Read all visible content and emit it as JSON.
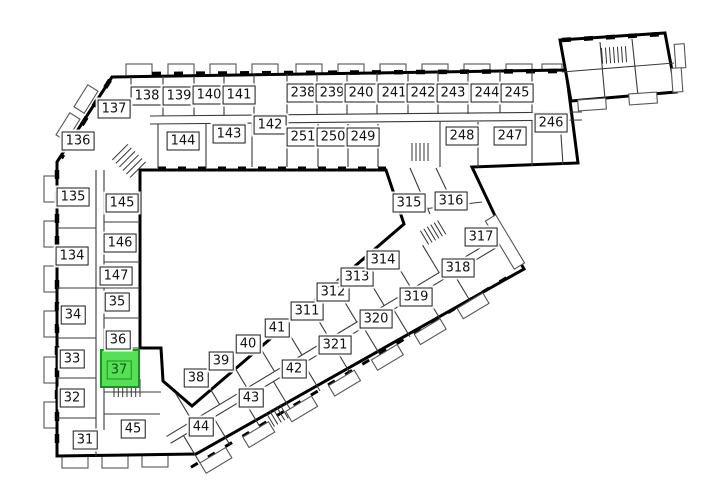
{
  "plan": {
    "name": "building-floor-plan",
    "highlighted_unit": "37",
    "colors": {
      "background": "#ffffff",
      "walls": "#000000",
      "label_bg": "#ffffff",
      "label_border": "#1a1a1a",
      "label_text": "#111111",
      "highlight_fill": "#57df57",
      "highlight_border": "#18931d",
      "highlight_text": "#0c5c10"
    },
    "units": [
      {
        "label": "138",
        "x": 147,
        "y": 96,
        "wing": "top-upper"
      },
      {
        "label": "139",
        "x": 179,
        "y": 96,
        "wing": "top-upper"
      },
      {
        "label": "140",
        "x": 209,
        "y": 95,
        "wing": "top-upper"
      },
      {
        "label": "141",
        "x": 239,
        "y": 95,
        "wing": "top-upper"
      },
      {
        "label": "238",
        "x": 303,
        "y": 93,
        "wing": "top-upper"
      },
      {
        "label": "239",
        "x": 332,
        "y": 93,
        "wing": "top-upper"
      },
      {
        "label": "240",
        "x": 361,
        "y": 93,
        "wing": "top-upper"
      },
      {
        "label": "241",
        "x": 394,
        "y": 93,
        "wing": "top-upper"
      },
      {
        "label": "242",
        "x": 423,
        "y": 93,
        "wing": "top-upper"
      },
      {
        "label": "243",
        "x": 453,
        "y": 93,
        "wing": "top-upper"
      },
      {
        "label": "244",
        "x": 487,
        "y": 93,
        "wing": "top-upper"
      },
      {
        "label": "245",
        "x": 517,
        "y": 93,
        "wing": "top-upper"
      },
      {
        "label": "137",
        "x": 114,
        "y": 109,
        "wing": "top-lower"
      },
      {
        "label": "136",
        "x": 78,
        "y": 141,
        "wing": "top-lower"
      },
      {
        "label": "144",
        "x": 183,
        "y": 141,
        "wing": "top-lower"
      },
      {
        "label": "143",
        "x": 229,
        "y": 134,
        "wing": "top-lower"
      },
      {
        "label": "142",
        "x": 270,
        "y": 125,
        "wing": "top-lower"
      },
      {
        "label": "251",
        "x": 303,
        "y": 137,
        "wing": "top-lower"
      },
      {
        "label": "250",
        "x": 333,
        "y": 137,
        "wing": "top-lower"
      },
      {
        "label": "249",
        "x": 363,
        "y": 137,
        "wing": "top-lower"
      },
      {
        "label": "248",
        "x": 462,
        "y": 136,
        "wing": "top-lower"
      },
      {
        "label": "247",
        "x": 510,
        "y": 136,
        "wing": "top-lower"
      },
      {
        "label": "246",
        "x": 551,
        "y": 123,
        "wing": "top-lower"
      },
      {
        "label": "135",
        "x": 73,
        "y": 197,
        "wing": "left"
      },
      {
        "label": "145",
        "x": 122,
        "y": 203,
        "wing": "left"
      },
      {
        "label": "146",
        "x": 120,
        "y": 243,
        "wing": "left"
      },
      {
        "label": "134",
        "x": 72,
        "y": 256,
        "wing": "left"
      },
      {
        "label": "147",
        "x": 116,
        "y": 276,
        "wing": "left"
      },
      {
        "label": "35",
        "x": 117,
        "y": 302,
        "wing": "left"
      },
      {
        "label": "34",
        "x": 73,
        "y": 315,
        "wing": "left"
      },
      {
        "label": "36",
        "x": 118,
        "y": 340,
        "wing": "left"
      },
      {
        "label": "33",
        "x": 72,
        "y": 359,
        "wing": "left"
      },
      {
        "label": "37",
        "x": 119,
        "y": 370,
        "wing": "left",
        "highlighted": true,
        "room": {
          "x": 100,
          "y": 349,
          "w": 40,
          "h": 39
        }
      },
      {
        "label": "32",
        "x": 72,
        "y": 398,
        "wing": "left"
      },
      {
        "label": "31",
        "x": 85,
        "y": 440,
        "wing": "left"
      },
      {
        "label": "45",
        "x": 133,
        "y": 429,
        "wing": "left"
      },
      {
        "label": "38",
        "x": 196,
        "y": 378,
        "wing": "diagonal-upper"
      },
      {
        "label": "39",
        "x": 221,
        "y": 361,
        "wing": "diagonal-upper"
      },
      {
        "label": "40",
        "x": 248,
        "y": 344,
        "wing": "diagonal-upper"
      },
      {
        "label": "41",
        "x": 277,
        "y": 328,
        "wing": "diagonal-upper"
      },
      {
        "label": "311",
        "x": 307,
        "y": 311,
        "wing": "diagonal-upper"
      },
      {
        "label": "312",
        "x": 333,
        "y": 292,
        "wing": "diagonal-upper"
      },
      {
        "label": "313",
        "x": 357,
        "y": 277,
        "wing": "diagonal-upper"
      },
      {
        "label": "314",
        "x": 383,
        "y": 260,
        "wing": "diagonal-upper"
      },
      {
        "label": "44",
        "x": 201,
        "y": 427,
        "wing": "diagonal-lower"
      },
      {
        "label": "43",
        "x": 251,
        "y": 398,
        "wing": "diagonal-lower"
      },
      {
        "label": "42",
        "x": 294,
        "y": 369,
        "wing": "diagonal-lower"
      },
      {
        "label": "321",
        "x": 335,
        "y": 345,
        "wing": "diagonal-lower"
      },
      {
        "label": "320",
        "x": 376,
        "y": 319,
        "wing": "diagonal-lower"
      },
      {
        "label": "319",
        "x": 416,
        "y": 297,
        "wing": "diagonal-lower"
      },
      {
        "label": "318",
        "x": 458,
        "y": 268,
        "wing": "diagonal-lower"
      },
      {
        "label": "317",
        "x": 481,
        "y": 237,
        "wing": "diagonal-lower"
      },
      {
        "label": "315",
        "x": 409,
        "y": 203,
        "wing": "connector"
      },
      {
        "label": "316",
        "x": 451,
        "y": 201,
        "wing": "connector"
      }
    ]
  }
}
